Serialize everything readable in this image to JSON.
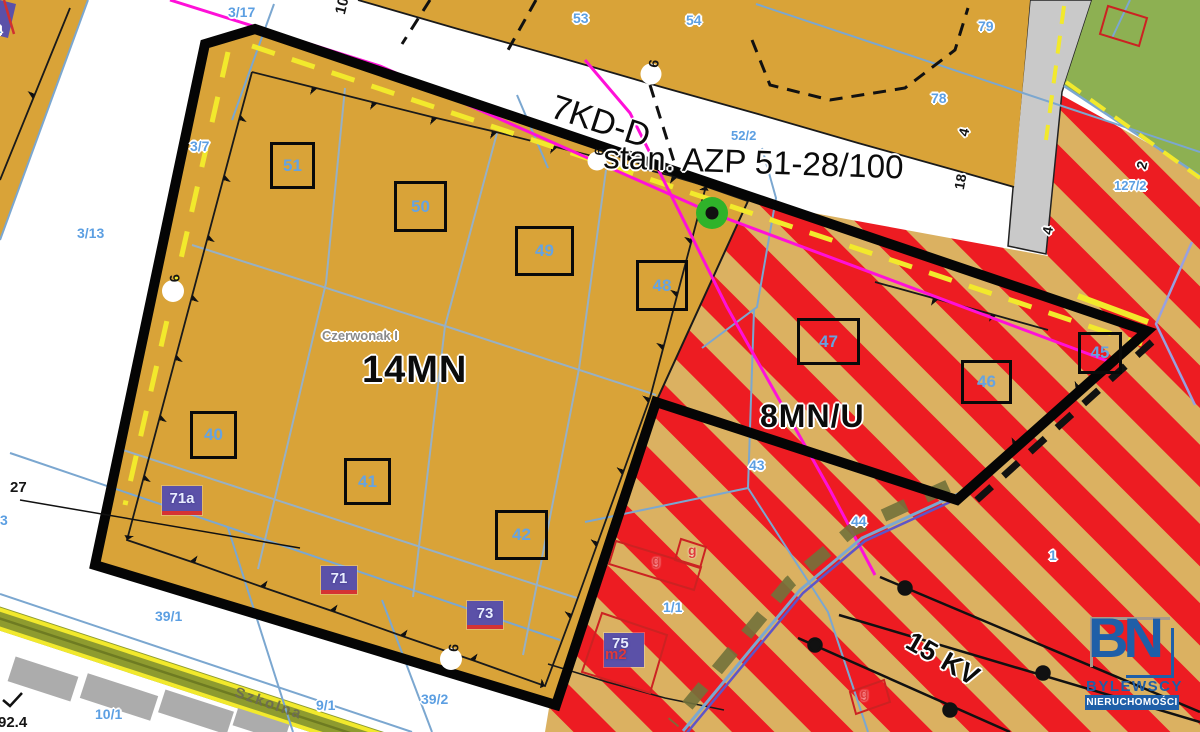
{
  "zones": {
    "main": "14MN",
    "mixed": "8MN/U",
    "road": "7KD-D",
    "azp": "stan. AZP 51-28/100",
    "power": "15 KV",
    "locality": "Czerwonak I",
    "street": "Szkolna"
  },
  "squares": [
    "51",
    "50",
    "49",
    "48",
    "47",
    "46",
    "45",
    "40",
    "41",
    "42"
  ],
  "purple_labels": [
    "71a",
    "71",
    "73",
    "75"
  ],
  "purple_sub": "m2",
  "blue_labels": [
    "3/14",
    "3/17",
    "3/7",
    "3/13",
    "53",
    "54",
    "52/2",
    "79",
    "78",
    "127/2",
    "43",
    "44",
    "1/1",
    "1",
    "39/1",
    "39/2",
    "10/1",
    "9/1",
    "3"
  ],
  "black_labels": [
    "27",
    "92.4",
    "10",
    "6",
    "6",
    "6",
    "6",
    "4",
    "18",
    "2",
    "4"
  ],
  "g_labels": [
    "g",
    "g",
    "g"
  ],
  "logo": {
    "initials": "BN",
    "name": "BYLEWSCY",
    "subtitle": "NIERUCHOMOŚCI"
  },
  "colors": {
    "zone_residential": "#D9A338",
    "zone_mixed_red": "#ED1C22",
    "zone_mixed_tan": "#DBB161",
    "zone_green": "#8DB052",
    "road_gray": "#C9C9C9",
    "road_olive": "#8E9B2F",
    "boundary_black": "#050505",
    "parcel_blue": "#7BA7D0",
    "label_blue": "#5C9FE2",
    "magenta": "#FF10D8",
    "yellow": "#F2E92C",
    "purple_box": "#5B51A8",
    "logo_blue": "#1F5FA8"
  }
}
